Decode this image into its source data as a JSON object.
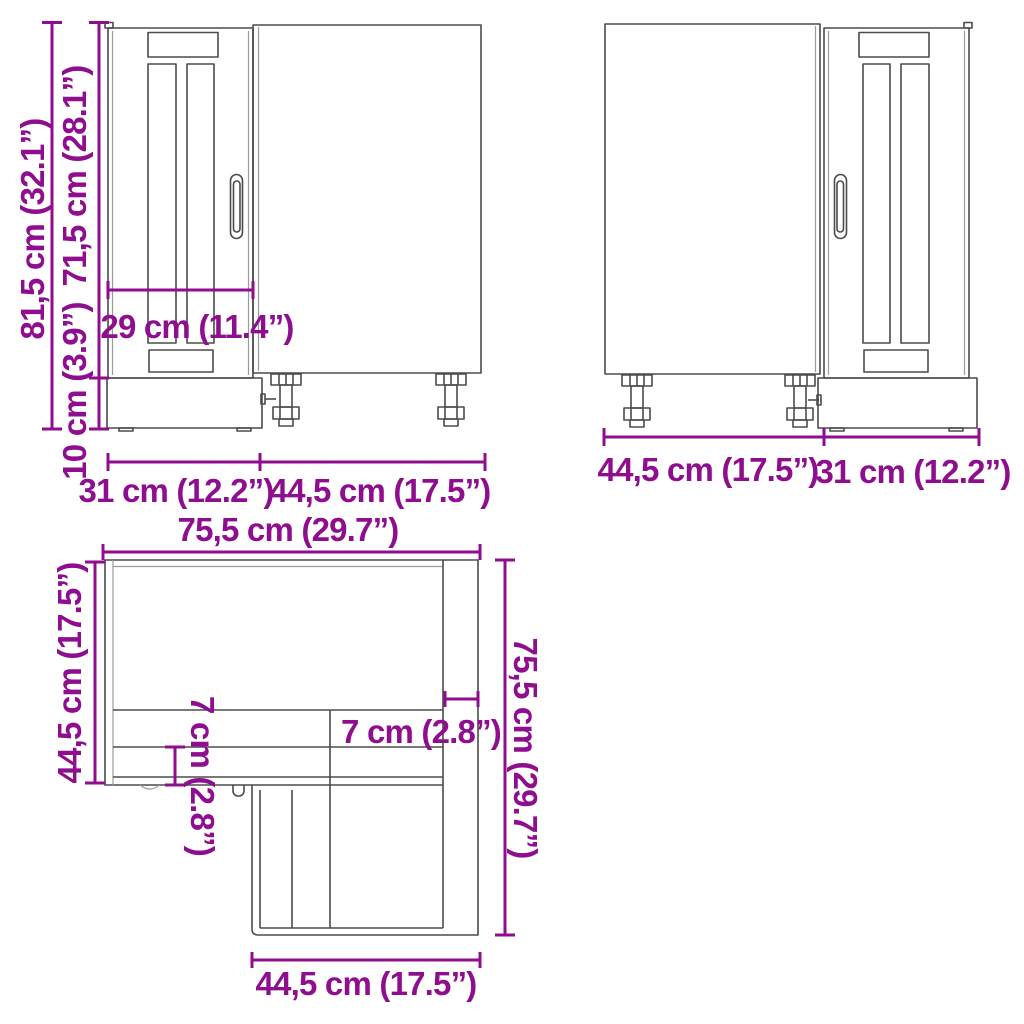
{
  "figure": {
    "type": "furniture-dimension-diagram",
    "subject": "corner base kitchen cabinet shown in three orthographic views (front-left, front-right, top plan)",
    "colors": {
      "dimension": "#8F0E8F",
      "outline": "#4b4b4b",
      "outline_light": "#9b9b9b",
      "background": "#FFFFFF"
    }
  },
  "views": {
    "front_left": {
      "name": "front view, door on left",
      "labels": {
        "total_height": "81,5 cm (32.1”)",
        "body_height": "71,5 cm (28.1”)",
        "plinth_height": "10 cm (3.9”)",
        "door_inner_width": "29 cm (11.4”)",
        "door_width": "31 cm (12.2”)",
        "side_width": "44,5 cm (17.5”)"
      }
    },
    "front_right": {
      "name": "front view, door on right",
      "labels": {
        "side_width": "44,5 cm (17.5”)",
        "door_width": "31 cm (12.2”)"
      }
    },
    "top_plan": {
      "name": "top plan view, L-shaped corner unit",
      "labels": {
        "top_width": "75,5 cm (29.7”)",
        "left_depth": "44,5 cm (17.5”)",
        "front_offset_left": "7 cm (2.8”)",
        "side_offset_right": "7 cm (2.8”)",
        "right_depth": "75,5 cm (29.7”)",
        "bottom_width": "44,5 cm (17.5”)"
      }
    }
  }
}
